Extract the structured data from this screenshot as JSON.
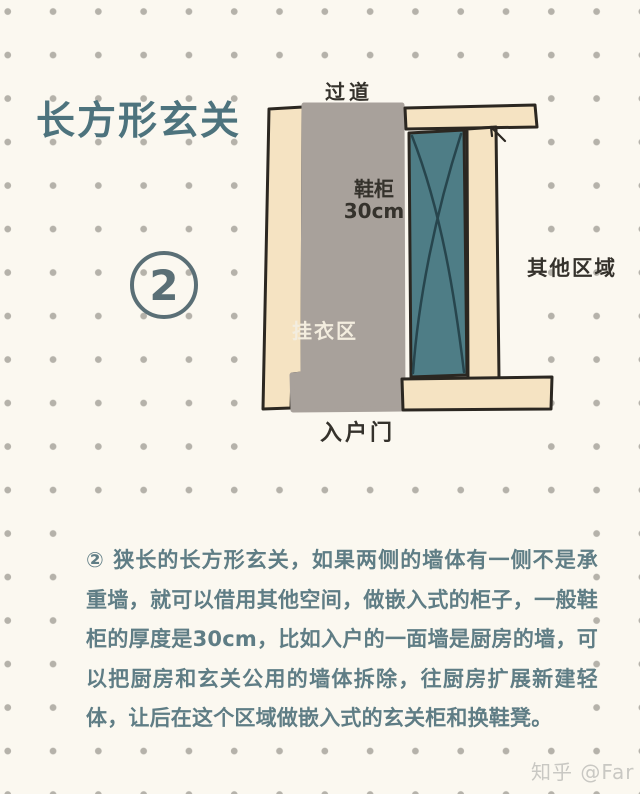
{
  "theme": {
    "bg": "#fbf8f0",
    "dot": "#b5b2aa",
    "accent": "#4d737d",
    "badge": "#5a6f76",
    "text": "#5f7d85",
    "outline": "#2b2721",
    "wall": "#f5e3c2",
    "floor": "#a8a19b",
    "cabinet": "#4e7d86",
    "cabinet-line": "#27454d",
    "label-dark": "#35322c",
    "label-light": "#f3eddf",
    "watermark": "#c9c8c3"
  },
  "header": {
    "title": "长方形玄关",
    "step_number": "2"
  },
  "diagram": {
    "labels": {
      "corridor": "过道",
      "shoe_cabinet_name": "鞋柜",
      "shoe_cabinet_depth": "30cm",
      "hanging_area": "挂衣区",
      "other_area": "其他区域",
      "entry_door": "入户门"
    }
  },
  "description": "② 狭长的长方形玄关，如果两侧的墙体有一侧不是承重墙，就可以借用其他空间，做嵌入式的柜子，一般鞋柜的厚度是30cm，比如入户的一面墙是厨房的墙，可以把厨房和玄关公用的墙体拆除，往厨房扩展新建轻体，让后在这个区域做嵌入式的玄关柜和换鞋凳。",
  "watermark": "知乎 @Far"
}
